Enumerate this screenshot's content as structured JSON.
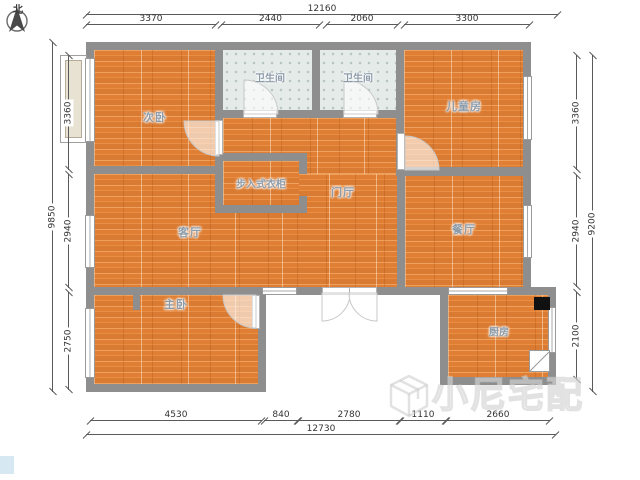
{
  "compass": {
    "label": "北"
  },
  "rooms": {
    "secondary_bedroom": "次卧",
    "bathroom_1": "卫生间",
    "bathroom_2": "卫生间",
    "kids_room": "儿童房",
    "walk_in_closet": "步入式衣柜",
    "foyer": "门厅",
    "living_room": "客厅",
    "dining_room": "餐厅",
    "master_bedroom": "主卧",
    "kitchen": "厨房"
  },
  "dimensions": {
    "top_total": "12160",
    "top_segments": [
      "3370",
      "2440",
      "2060",
      "3300"
    ],
    "left_total": "9850",
    "left_segments": [
      "3360",
      "2940",
      "2750"
    ],
    "right_total": "9200",
    "right_segments": [
      "3360",
      "2940",
      "2100"
    ],
    "bottom_segments": [
      "4530",
      "840",
      "2780",
      "1110",
      "2660"
    ],
    "bottom_total": "12730"
  },
  "watermark": {
    "text": "小尼宅配"
  },
  "colors": {
    "wall": "#8e8e8e",
    "wood_floor": "#e6853a",
    "bathroom_tile": "#e4ebe9",
    "room_label": "#8e9caa"
  }
}
